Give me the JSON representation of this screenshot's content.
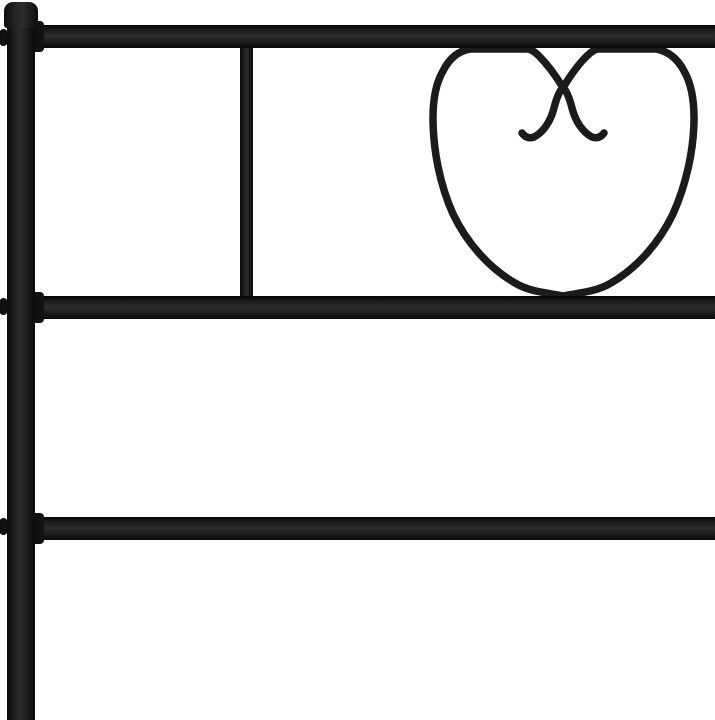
{
  "scene": {
    "description": "Close-up product photo of a black metal bed headboard on a white background, featuring a decorative heart-shaped wire scroll between the top and middle rails",
    "background_color": "#ffffff",
    "frame_color": "#1b1b1b"
  },
  "parts": {
    "post": "Left vertical post of metal bed frame",
    "post_cap": "Rounded cap on top of left post",
    "top_rail": "Top horizontal rail",
    "middle_rail": "Middle horizontal rail",
    "lower_rail": "Lower horizontal rail",
    "slat": "Vertical slat between top and middle rails",
    "heart": "Heart-shaped scroll ornament with interlocking center curls",
    "bolt_1": "Bolt end on post at top rail joint",
    "bolt_2": "Bolt end on post at middle rail joint",
    "bolt_3": "Bolt end on post at lower rail joint",
    "collar_top": "Weld collar at top rail joint",
    "collar_middle": "Weld collar at middle rail joint",
    "collar_lower": "Weld collar at lower rail joint"
  }
}
